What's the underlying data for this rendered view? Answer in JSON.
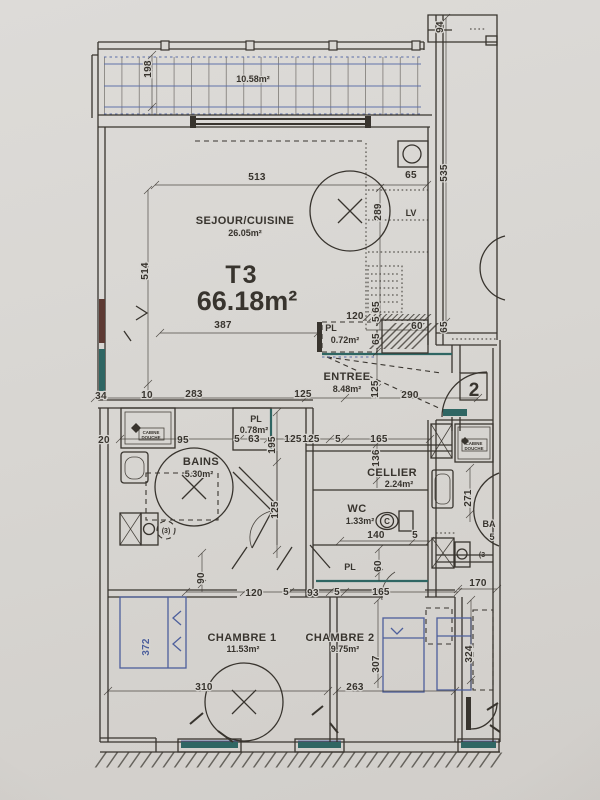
{
  "colors": {
    "paper": "#d8d6d2",
    "ink": "#38342e",
    "tile_blue": "#5a6da8",
    "bed_blue": "#4d5f9c",
    "window_teal": "#2f6663",
    "window_red": "#5d3a33"
  },
  "plan": {
    "apartment_type": "T3",
    "total_area": "66.18m²",
    "rooms": {
      "balcony": {
        "area": "10.58m²"
      },
      "sejour": {
        "name": "SEJOUR/CUISINE",
        "area": "26.05m²"
      },
      "entree": {
        "name": "ENTREE",
        "area": "8.48m²"
      },
      "pl_entree": {
        "name": "PL",
        "area": "0.72m²"
      },
      "bains": {
        "name": "BAINS",
        "area": "5.30m²"
      },
      "pl_bains": {
        "name": "PL",
        "area": "0.78m²"
      },
      "cellier": {
        "name": "CELLIER",
        "area": "2.24m²"
      },
      "wc": {
        "name": "WC",
        "area": "1.33m²"
      },
      "pl_chambre": {
        "name": "PL"
      },
      "chambre1": {
        "name": "CHAMBRE 1",
        "area": "11.53m²"
      },
      "chambre2": {
        "name": "CHAMBRE 2",
        "area": "9.75m²"
      }
    },
    "annotations": {
      "lv": "LV",
      "door_number": "2",
      "cabine": "CABINE",
      "douche": "DOUCHE",
      "washer_note": "(3)",
      "washer_note_neighbor": "(3",
      "neighbor_bains": "BA",
      "neighbor_area": "5",
      "toilet_mark": "C"
    },
    "dimensions": [
      {
        "v": "198",
        "x": 151,
        "y": 69,
        "r": -90
      },
      {
        "v": "513",
        "x": 257,
        "y": 180
      },
      {
        "v": "94",
        "x": 443,
        "y": 27,
        "r": -90
      },
      {
        "v": "535",
        "x": 447,
        "y": 173,
        "r": -90
      },
      {
        "v": "65",
        "x": 411,
        "y": 178
      },
      {
        "v": "289",
        "x": 381,
        "y": 212,
        "r": -90
      },
      {
        "v": "514",
        "x": 148,
        "y": 271,
        "r": -90
      },
      {
        "v": "387",
        "x": 223,
        "y": 328
      },
      {
        "v": "120",
        "x": 355,
        "y": 319
      },
      {
        "v": "65",
        "x": 379,
        "y": 307,
        "r": -90
      },
      {
        "v": "5",
        "x": 379,
        "y": 319,
        "r": -90
      },
      {
        "v": "65",
        "x": 379,
        "y": 339,
        "r": -90
      },
      {
        "v": "60",
        "x": 417,
        "y": 329
      },
      {
        "v": "65",
        "x": 447,
        "y": 327,
        "r": -90
      },
      {
        "v": "34",
        "x": 101,
        "y": 399
      },
      {
        "v": "10",
        "x": 147,
        "y": 398
      },
      {
        "v": "283",
        "x": 194,
        "y": 397
      },
      {
        "v": "125",
        "x": 303,
        "y": 397
      },
      {
        "v": "290",
        "x": 410,
        "y": 398
      },
      {
        "v": "125",
        "x": 378,
        "y": 389,
        "r": -90
      },
      {
        "v": "20",
        "x": 104,
        "y": 443
      },
      {
        "v": "95",
        "x": 183,
        "y": 443
      },
      {
        "v": "5",
        "x": 237,
        "y": 442
      },
      {
        "v": "63",
        "x": 254,
        "y": 442
      },
      {
        "v": "125",
        "x": 293,
        "y": 442
      },
      {
        "v": "195",
        "x": 275,
        "y": 445,
        "r": -90
      },
      {
        "v": "125",
        "x": 278,
        "y": 510,
        "r": -90
      },
      {
        "v": "125",
        "x": 311,
        "y": 442
      },
      {
        "v": "5",
        "x": 338,
        "y": 442
      },
      {
        "v": "165",
        "x": 379,
        "y": 442
      },
      {
        "v": "136",
        "x": 379,
        "y": 458,
        "r": -90
      },
      {
        "v": "140",
        "x": 376,
        "y": 538
      },
      {
        "v": "5",
        "x": 415,
        "y": 538
      },
      {
        "v": "60",
        "x": 381,
        "y": 566,
        "r": -90
      },
      {
        "v": "90",
        "x": 204,
        "y": 578,
        "r": -90
      },
      {
        "v": "120",
        "x": 254,
        "y": 596
      },
      {
        "v": "5",
        "x": 286,
        "y": 595
      },
      {
        "v": "93",
        "x": 313,
        "y": 596
      },
      {
        "v": "5",
        "x": 337,
        "y": 595
      },
      {
        "v": "165",
        "x": 381,
        "y": 595
      },
      {
        "v": "170",
        "x": 478,
        "y": 586
      },
      {
        "v": "372",
        "x": 149,
        "y": 647,
        "r": -90,
        "c": "blue"
      },
      {
        "v": "310",
        "x": 204,
        "y": 690
      },
      {
        "v": "307",
        "x": 379,
        "y": 664,
        "r": -90
      },
      {
        "v": "263",
        "x": 355,
        "y": 690
      },
      {
        "v": "324",
        "x": 472,
        "y": 654,
        "r": -90
      },
      {
        "v": "271",
        "x": 471,
        "y": 498,
        "r": -90
      }
    ]
  }
}
